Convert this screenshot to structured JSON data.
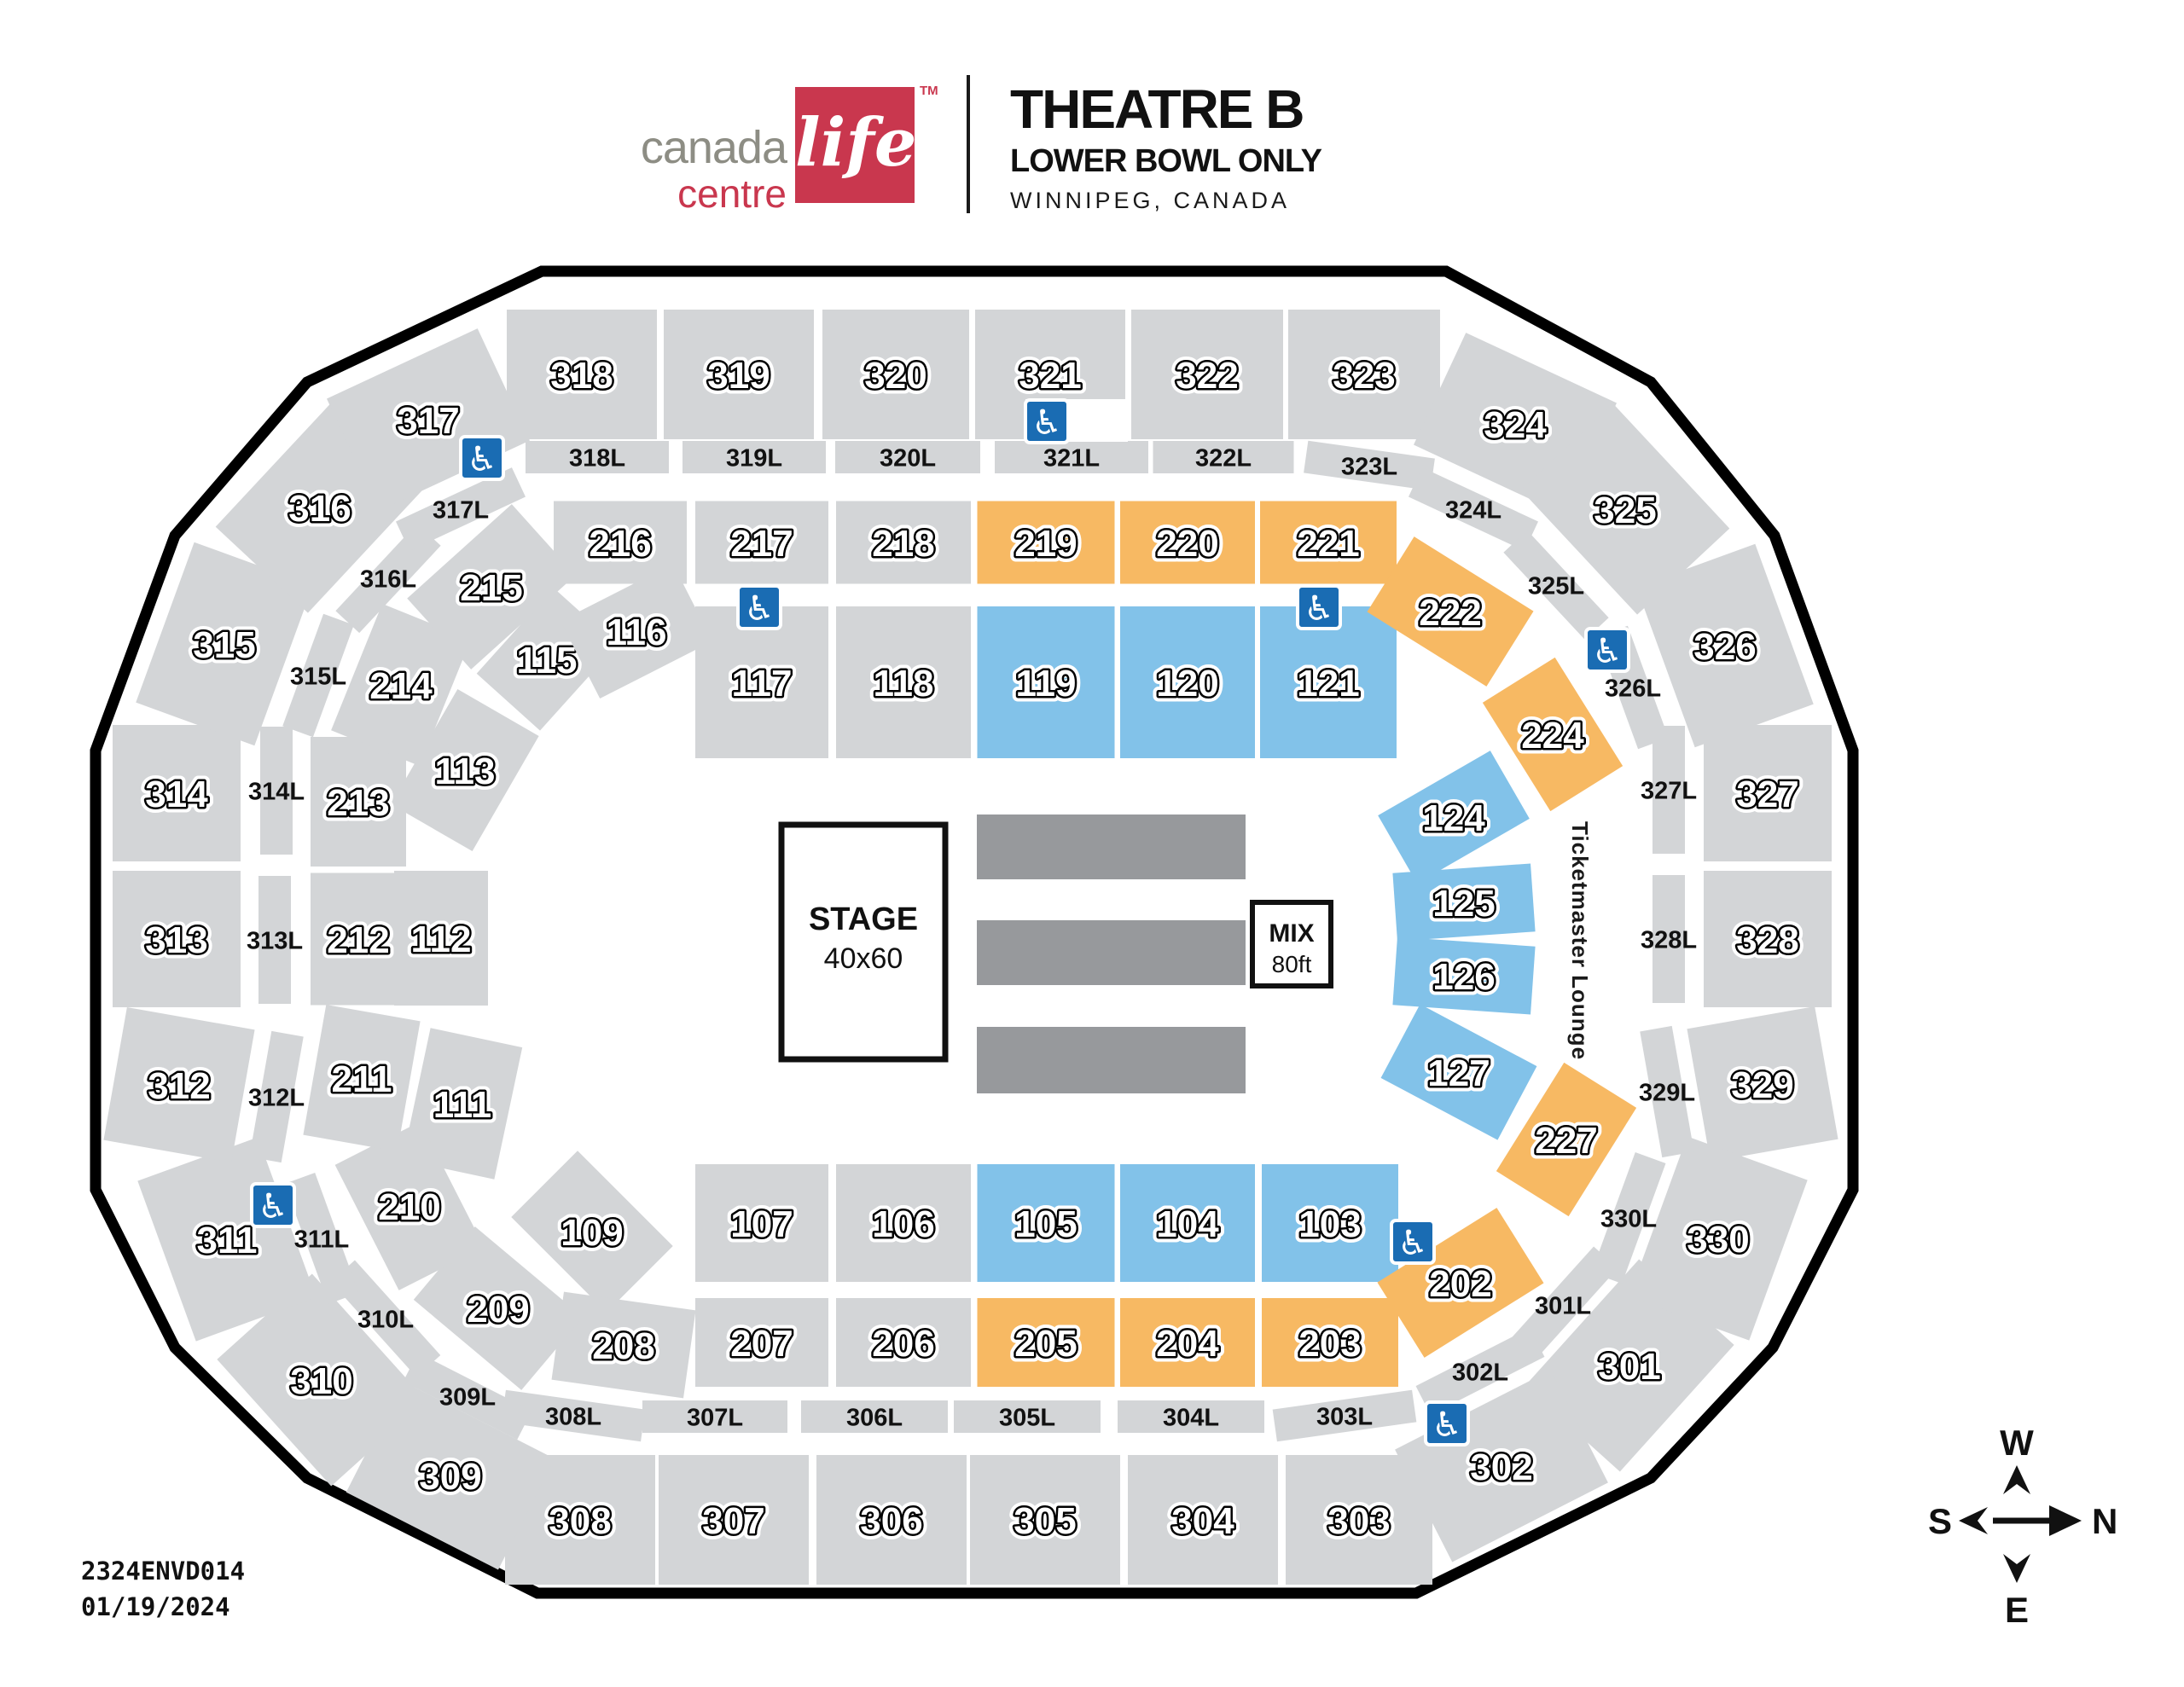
{
  "header": {
    "logo": {
      "word1": "canada",
      "word2": "centre",
      "script": "life",
      "tm": "TM"
    },
    "title": "THEATRE B",
    "subtitle": "LOWER BOWL ONLY",
    "location": "WINNIPEG, CANADA"
  },
  "floor": {
    "stage_label": "STAGE",
    "stage_size": "40x60",
    "mix_label": "MIX",
    "mix_size": "80ft",
    "lounge": "Ticketmaster Lounge"
  },
  "compass": {
    "top": "W",
    "right": "N",
    "bottom": "E",
    "left": "S"
  },
  "footer": {
    "code": "2324ENVD014",
    "date": "01/19/2024"
  },
  "accessibility": {
    "name": "wheelchair-accessible",
    "glyph": "♿"
  },
  "colors": {
    "section_gray": "#d3d5d7",
    "floor_gray": "#97999c",
    "orange": "#f7b963",
    "blue": "#82c2e9",
    "access_blue": "#1a6cb3",
    "outline": "#000000",
    "brand_red": "#c9374e",
    "logo_gray": "#8d8d84"
  },
  "sections": {
    "level300": [
      {
        "label": "301",
        "color": "gray"
      },
      {
        "label": "302",
        "color": "gray"
      },
      {
        "label": "303",
        "color": "gray"
      },
      {
        "label": "304",
        "color": "gray"
      },
      {
        "label": "305",
        "color": "gray"
      },
      {
        "label": "306",
        "color": "gray"
      },
      {
        "label": "307",
        "color": "gray"
      },
      {
        "label": "308",
        "color": "gray"
      },
      {
        "label": "309",
        "color": "gray"
      },
      {
        "label": "310",
        "color": "gray"
      },
      {
        "label": "311",
        "color": "gray"
      },
      {
        "label": "312",
        "color": "gray"
      },
      {
        "label": "313",
        "color": "gray"
      },
      {
        "label": "314",
        "color": "gray"
      },
      {
        "label": "315",
        "color": "gray"
      },
      {
        "label": "316",
        "color": "gray"
      },
      {
        "label": "317",
        "color": "gray"
      },
      {
        "label": "318",
        "color": "gray"
      },
      {
        "label": "319",
        "color": "gray"
      },
      {
        "label": "320",
        "color": "gray"
      },
      {
        "label": "321",
        "color": "gray"
      },
      {
        "label": "322",
        "color": "gray"
      },
      {
        "label": "323",
        "color": "gray"
      },
      {
        "label": "324",
        "color": "gray"
      },
      {
        "label": "325",
        "color": "gray"
      },
      {
        "label": "326",
        "color": "gray"
      },
      {
        "label": "327",
        "color": "gray"
      },
      {
        "label": "328",
        "color": "gray"
      },
      {
        "label": "329",
        "color": "gray"
      },
      {
        "label": "330",
        "color": "gray"
      }
    ],
    "levelL": [
      {
        "label": "301L",
        "color": "gray"
      },
      {
        "label": "302L",
        "color": "gray"
      },
      {
        "label": "303L",
        "color": "gray"
      },
      {
        "label": "304L",
        "color": "gray"
      },
      {
        "label": "305L",
        "color": "gray"
      },
      {
        "label": "306L",
        "color": "gray"
      },
      {
        "label": "307L",
        "color": "gray"
      },
      {
        "label": "308L",
        "color": "gray"
      },
      {
        "label": "309L",
        "color": "gray"
      },
      {
        "label": "310L",
        "color": "gray"
      },
      {
        "label": "311L",
        "color": "gray"
      },
      {
        "label": "312L",
        "color": "gray"
      },
      {
        "label": "313L",
        "color": "gray"
      },
      {
        "label": "314L",
        "color": "gray"
      },
      {
        "label": "315L",
        "color": "gray"
      },
      {
        "label": "316L",
        "color": "gray"
      },
      {
        "label": "317L",
        "color": "gray"
      },
      {
        "label": "318L",
        "color": "gray"
      },
      {
        "label": "319L",
        "color": "gray"
      },
      {
        "label": "320L",
        "color": "gray"
      },
      {
        "label": "321L",
        "color": "gray"
      },
      {
        "label": "322L",
        "color": "gray"
      },
      {
        "label": "323L",
        "color": "gray"
      },
      {
        "label": "324L",
        "color": "gray"
      },
      {
        "label": "325L",
        "color": "gray"
      },
      {
        "label": "326L",
        "color": "gray"
      },
      {
        "label": "327L",
        "color": "gray"
      },
      {
        "label": "328L",
        "color": "gray"
      },
      {
        "label": "329L",
        "color": "gray"
      },
      {
        "label": "330L",
        "color": "gray"
      }
    ],
    "level100": [
      {
        "label": "103",
        "color": "blue"
      },
      {
        "label": "104",
        "color": "blue"
      },
      {
        "label": "105",
        "color": "blue"
      },
      {
        "label": "106",
        "color": "gray"
      },
      {
        "label": "107",
        "color": "gray"
      },
      {
        "label": "109",
        "color": "gray"
      },
      {
        "label": "111",
        "color": "gray"
      },
      {
        "label": "112",
        "color": "gray"
      },
      {
        "label": "113",
        "color": "gray"
      },
      {
        "label": "115",
        "color": "gray"
      },
      {
        "label": "116",
        "color": "gray"
      },
      {
        "label": "117",
        "color": "gray"
      },
      {
        "label": "118",
        "color": "gray"
      },
      {
        "label": "119",
        "color": "blue"
      },
      {
        "label": "120",
        "color": "blue"
      },
      {
        "label": "121",
        "color": "blue"
      },
      {
        "label": "124",
        "color": "blue"
      },
      {
        "label": "125",
        "color": "blue"
      },
      {
        "label": "126",
        "color": "blue"
      },
      {
        "label": "127",
        "color": "blue"
      }
    ],
    "level200": [
      {
        "label": "202",
        "color": "orange"
      },
      {
        "label": "203",
        "color": "orange"
      },
      {
        "label": "204",
        "color": "orange"
      },
      {
        "label": "205",
        "color": "orange"
      },
      {
        "label": "206",
        "color": "gray"
      },
      {
        "label": "207",
        "color": "gray"
      },
      {
        "label": "208",
        "color": "gray"
      },
      {
        "label": "209",
        "color": "gray"
      },
      {
        "label": "210",
        "color": "gray"
      },
      {
        "label": "211",
        "color": "gray"
      },
      {
        "label": "212",
        "color": "gray"
      },
      {
        "label": "213",
        "color": "gray"
      },
      {
        "label": "214",
        "color": "gray"
      },
      {
        "label": "215",
        "color": "gray"
      },
      {
        "label": "216",
        "color": "gray"
      },
      {
        "label": "217",
        "color": "gray"
      },
      {
        "label": "218",
        "color": "gray"
      },
      {
        "label": "219",
        "color": "orange"
      },
      {
        "label": "220",
        "color": "orange"
      },
      {
        "label": "221",
        "color": "orange"
      },
      {
        "label": "222",
        "color": "orange"
      },
      {
        "label": "224",
        "color": "orange"
      },
      {
        "label": "227",
        "color": "orange"
      }
    ]
  }
}
